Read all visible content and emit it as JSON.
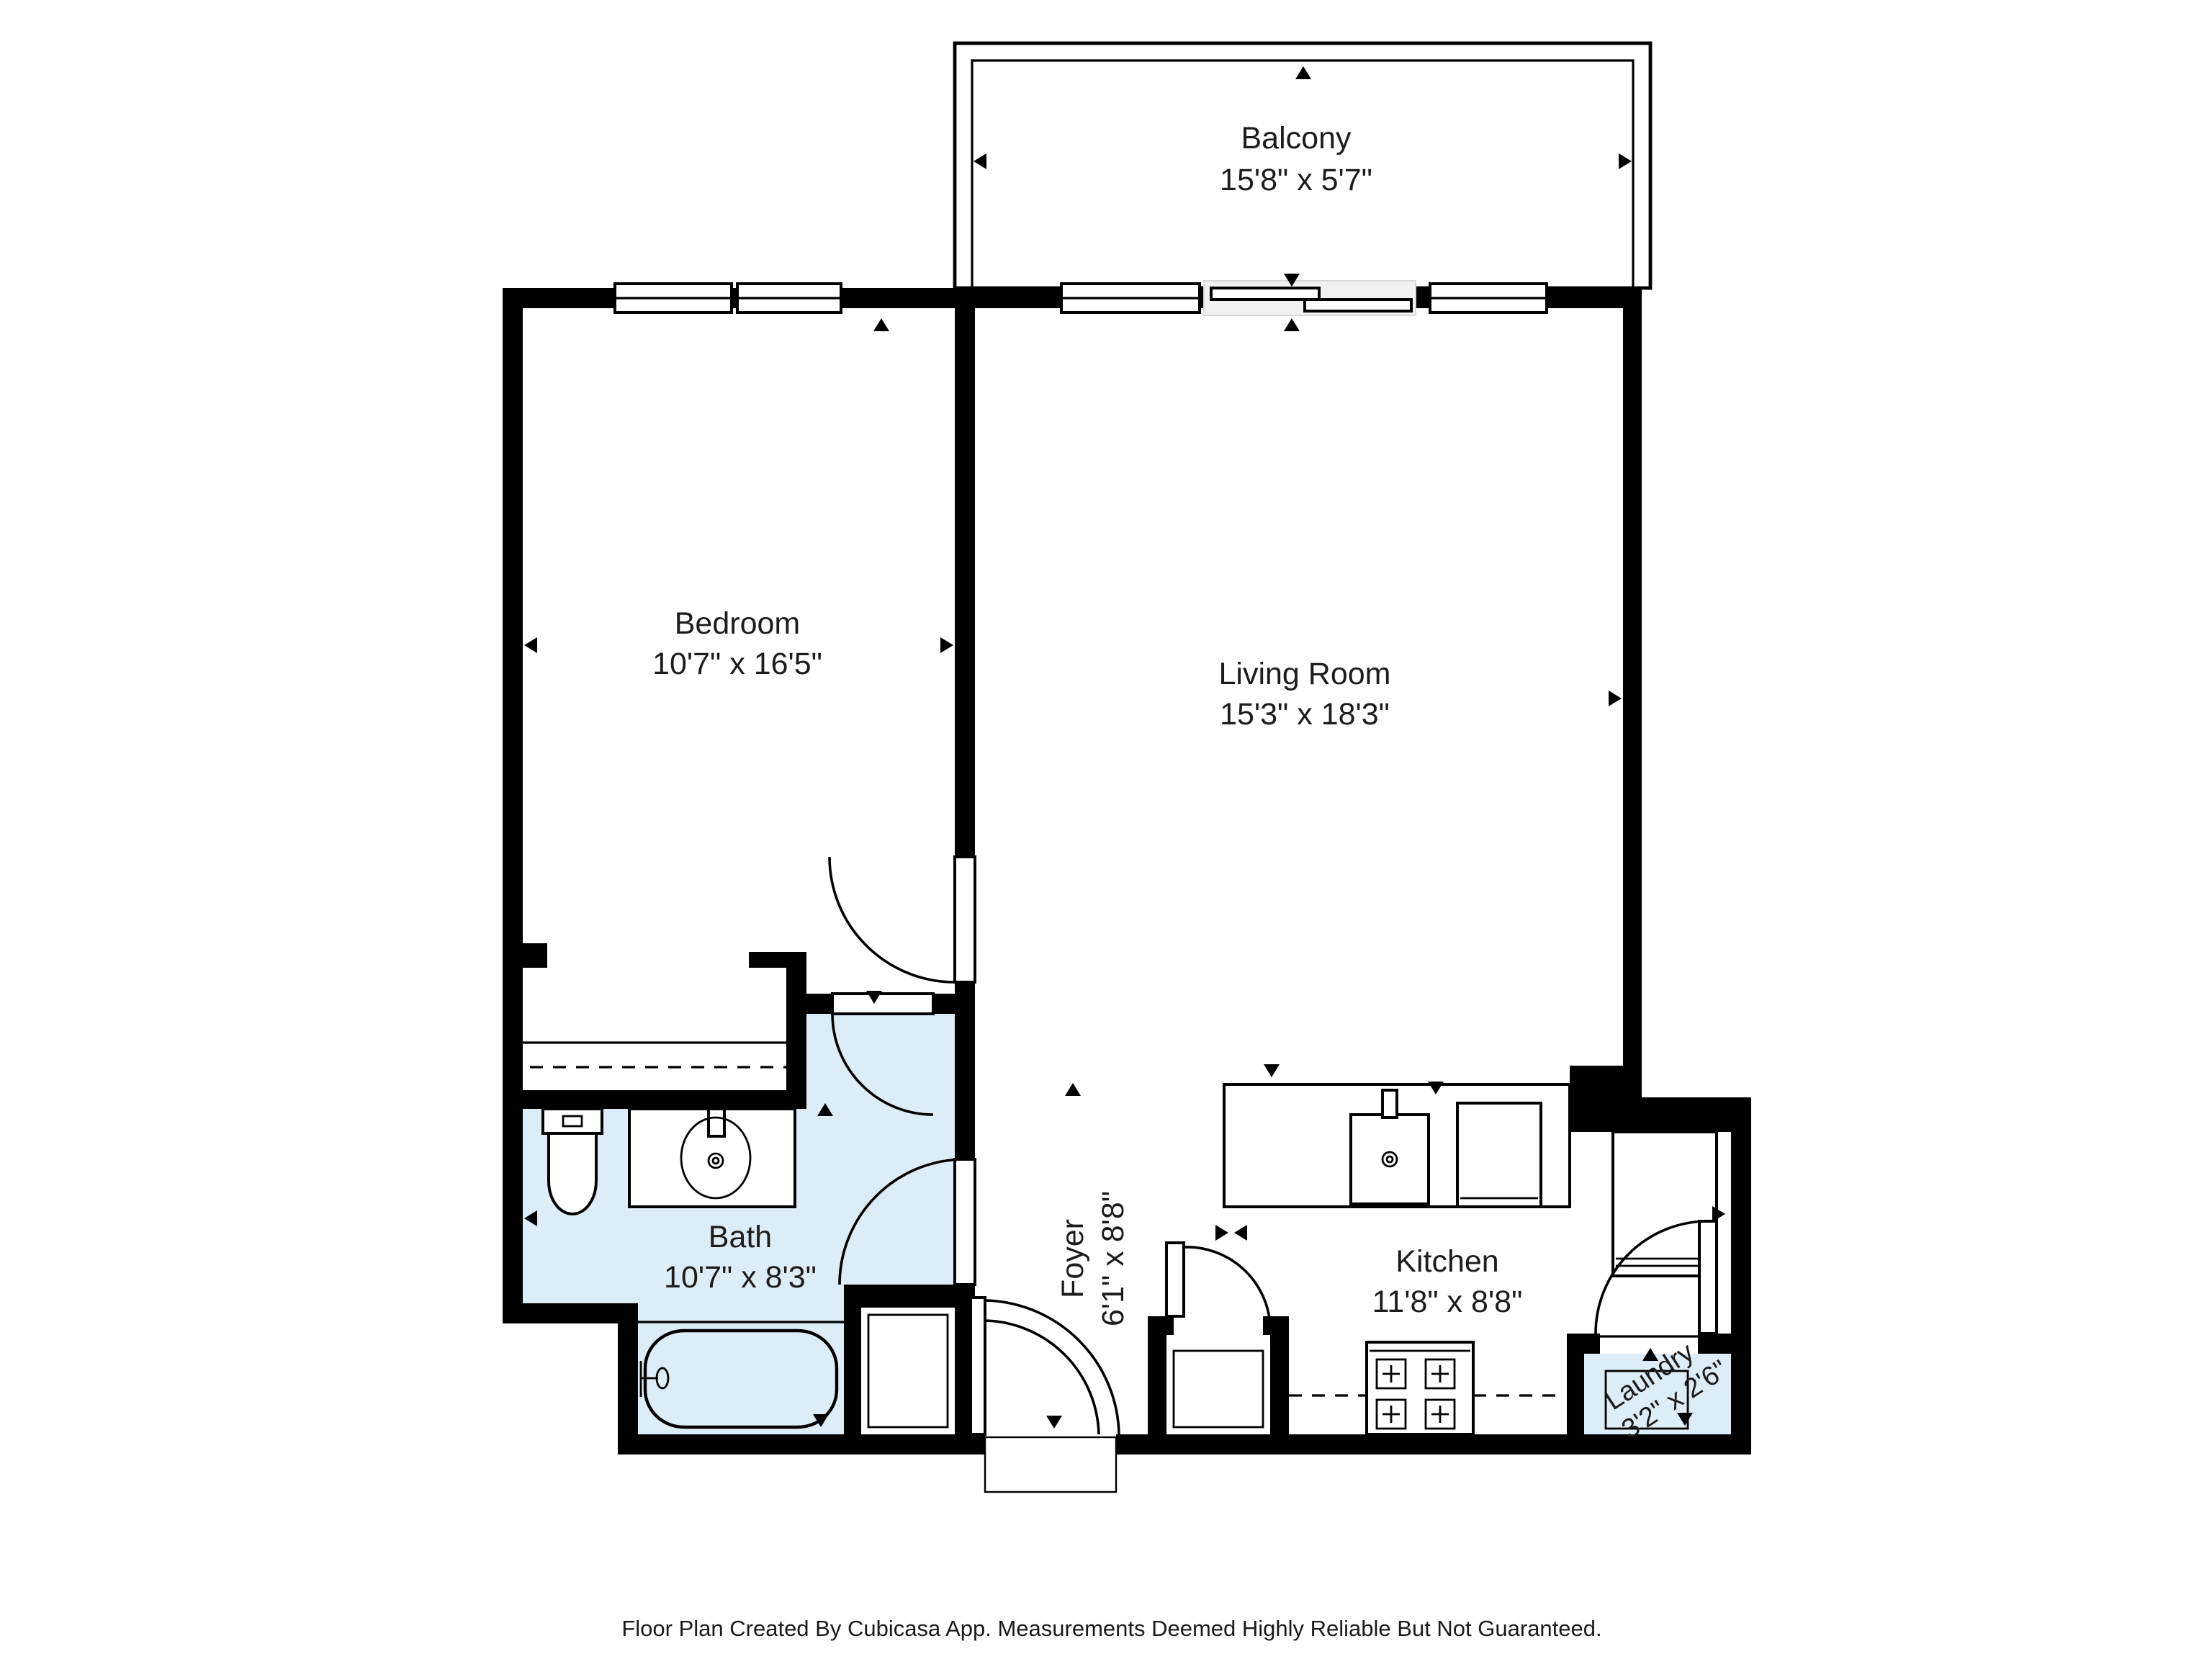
{
  "floorplan": {
    "app_attribution": "Cubicasa",
    "rooms": [
      {
        "name": "Balcony",
        "dims": "15'8\" x 5'7\""
      },
      {
        "name": "Bedroom",
        "dims": "10'7\" x 16'5\""
      },
      {
        "name": "Living Room",
        "dims": "15'3\" x 18'3\""
      },
      {
        "name": "Bath",
        "dims": "10'7\" x 8'3\""
      },
      {
        "name": "Foyer",
        "dims": "6'1\" x 8'8\""
      },
      {
        "name": "Kitchen",
        "dims": "11'8\" x 8'8\""
      },
      {
        "name": "Laundry",
        "dims": "3'2\" x 2'6\""
      }
    ],
    "fixtures": [
      "toilet",
      "bathroom-sink-vanity",
      "bathtub",
      "closet",
      "kitchen-sink",
      "dishwasher",
      "refrigerator",
      "stove",
      "washer"
    ],
    "colors": {
      "wall": "#000000",
      "wet-room-fill": "#ddedf8",
      "background": "#ffffff",
      "text": "#1c1c1c"
    },
    "footer": "Floor Plan Created By Cubicasa App. Measurements Deemed Highly Reliable But Not Guaranteed."
  }
}
